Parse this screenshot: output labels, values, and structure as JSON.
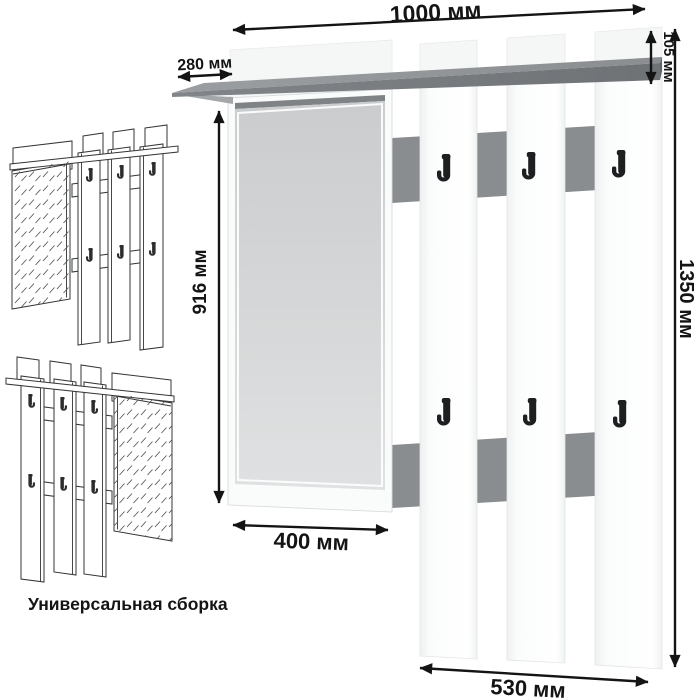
{
  "product_diagram": {
    "dimension_labels": {
      "width_total": "1000 мм",
      "shelf_depth": "280 мм",
      "top_strip_height": "105 мм",
      "mirror_height": "916 мм",
      "height_total": "1350 мм",
      "mirror_width": "400 мм",
      "hook_panel_width": "530 мм"
    },
    "caption": "Универсальная сборка",
    "icons": [
      "coat-hook-icon"
    ],
    "colors": {
      "dimension_ink": "#141414",
      "shelf_top": "#8f9396",
      "shelf_front": "#75797c",
      "shelf_end": "#5f6366",
      "shelf_underside": "#a4a7a9",
      "rail": "#898d90",
      "hook": "#1e1f21",
      "slat": "#fcfcfd",
      "slat_edge": "#e3e5e6",
      "backing": "#f5f6f6",
      "backing_edge": "#e8eaea",
      "frame": "#fafbfb",
      "frame_edge": "#d9dbdd",
      "glass_strip": "#7f8385",
      "bevel": "#ffffff",
      "sketch_ink": "#333435"
    }
  }
}
